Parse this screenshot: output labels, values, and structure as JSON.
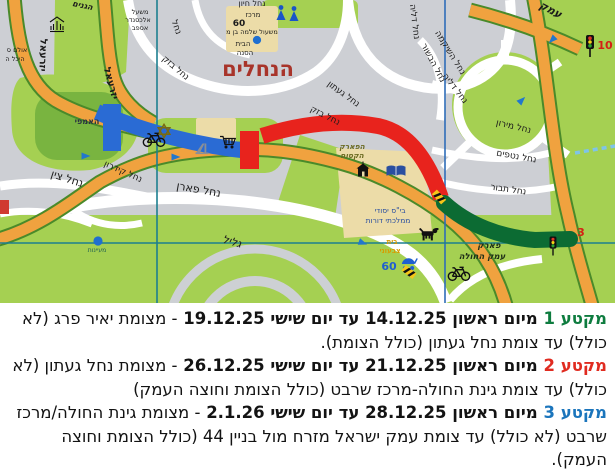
{
  "map": {
    "title": "הנחלים",
    "grid_color": "#1d7f8f",
    "route_segments": [
      {
        "name": "segment-1-closure",
        "color": "#2a6bd4"
      },
      {
        "name": "segment-2-closure",
        "color": "#e8231d"
      },
      {
        "name": "segment-3-closure",
        "color": "#0c6b33"
      }
    ],
    "labels": [
      {
        "t": "הנחלים",
        "x": 258,
        "y": 76,
        "s": 21,
        "c": "#a8342a",
        "w": 700
      },
      {
        "t": "הגנים",
        "x": 82,
        "y": 8,
        "r": 12,
        "s": 8,
        "w": 700,
        "i": true
      },
      {
        "t": "יזרעאל",
        "x": 40,
        "y": 55,
        "r": 92,
        "s": 10,
        "w": 700
      },
      {
        "t": "יזרעאל",
        "x": 108,
        "y": 84,
        "r": 75,
        "s": 10,
        "w": 700
      },
      {
        "t": "אולם ס",
        "x": 17,
        "y": 52,
        "s": 6.5
      },
      {
        "t": "היכל ה",
        "x": 15,
        "y": 61,
        "s": 6.5
      },
      {
        "t": "משעל",
        "x": 140,
        "y": 14,
        "s": 6.5
      },
      {
        "t": "אלכסנדר",
        "x": 138,
        "y": 22,
        "s": 6.5
      },
      {
        "t": "אספב",
        "x": 140,
        "y": 30,
        "s": 6.5
      },
      {
        "t": "נחל",
        "x": 174,
        "y": 28,
        "r": 70,
        "s": 9
      },
      {
        "t": "נחל בזק",
        "x": 174,
        "y": 70,
        "r": 40,
        "s": 9
      },
      {
        "t": "נחל חיון",
        "x": 252,
        "y": 6,
        "s": 8
      },
      {
        "t": "מרכז",
        "x": 253,
        "y": 17,
        "s": 7
      },
      {
        "t": "60",
        "x": 239,
        "y": 26,
        "s": 9,
        "w": 700
      },
      {
        "t": "משעול שלמה בן מ",
        "x": 252,
        "y": 34,
        "s": 6.5
      },
      {
        "t": "הבית",
        "x": 243,
        "y": 46,
        "s": 7
      },
      {
        "t": "הסנה",
        "x": 245,
        "y": 55,
        "s": 7
      },
      {
        "t": "נחל דליה",
        "x": 412,
        "y": 22,
        "r": 83,
        "s": 9
      },
      {
        "t": "נחל השיקמה",
        "x": 448,
        "y": 54,
        "r": 58,
        "s": 9
      },
      {
        "t": "נחל הבשור",
        "x": 431,
        "y": 64,
        "r": 62,
        "s": 9
      },
      {
        "t": "נחל דליה",
        "x": 453,
        "y": 90,
        "r": 52,
        "s": 9
      },
      {
        "t": "נחל געתון",
        "x": 342,
        "y": 96,
        "r": 36,
        "s": 9
      },
      {
        "t": "נחל בזק",
        "x": 324,
        "y": 118,
        "r": 27,
        "s": 9
      },
      {
        "t": "עמק",
        "x": 549,
        "y": 13,
        "r": 28,
        "s": 11,
        "w": 700,
        "i": true
      },
      {
        "t": "נחל מירון",
        "x": 513,
        "y": 129,
        "r": 13,
        "s": 9
      },
      {
        "t": "נחל נטפים",
        "x": 516,
        "y": 159,
        "r": 10,
        "s": 9
      },
      {
        "t": "נחל תבור",
        "x": 508,
        "y": 192,
        "r": 8,
        "s": 9
      },
      {
        "t": "האמפי",
        "x": 87,
        "y": 124,
        "s": 8,
        "w": 700,
        "c": "#2b3340"
      },
      {
        "t": "הפארק",
        "x": 352,
        "y": 149,
        "s": 7.5,
        "w": 700,
        "i": true,
        "c": "#6b6b22"
      },
      {
        "t": "הקסום",
        "x": 352,
        "y": 158,
        "s": 7.5,
        "w": 700,
        "i": true,
        "c": "#6b6b22"
      },
      {
        "t": "נחל קידרון",
        "x": 122,
        "y": 174,
        "r": 24,
        "s": 9
      },
      {
        "t": "נחל צין",
        "x": 66,
        "y": 182,
        "r": 18,
        "s": 11
      },
      {
        "t": "נחל פארן",
        "x": 198,
        "y": 193,
        "r": 10,
        "s": 11
      },
      {
        "t": "גליל",
        "x": 231,
        "y": 245,
        "r": 16,
        "s": 11,
        "i": true
      },
      {
        "t": "מעיינות",
        "x": 97,
        "y": 252,
        "s": 6,
        "c": "#1a5b50"
      },
      {
        "t": "בי\"ס יסודי",
        "x": 390,
        "y": 213,
        "s": 7.5,
        "c": "#2a4fa0"
      },
      {
        "t": "ממלכתי דורות",
        "x": 388,
        "y": 223,
        "s": 7.5,
        "c": "#2a4fa0"
      },
      {
        "t": "בית",
        "x": 392,
        "y": 244,
        "s": 7,
        "w": 700,
        "c": "#d89b00"
      },
      {
        "t": "צבעוני",
        "x": 390,
        "y": 253,
        "s": 7,
        "w": 700,
        "c": "#d89b00"
      },
      {
        "t": "60",
        "x": 389,
        "y": 270,
        "s": 11,
        "w": 700,
        "c": "#1f5fd0"
      },
      {
        "t": "פארק",
        "x": 489,
        "y": 248,
        "s": 8.5,
        "w": 700,
        "i": true,
        "c": "#203018"
      },
      {
        "t": "עמק החולה",
        "x": 482,
        "y": 259,
        "s": 8.5,
        "w": 700,
        "i": true,
        "c": "#203018"
      },
      {
        "t": "10",
        "x": 605,
        "y": 49,
        "s": 11,
        "w": 700,
        "c": "#d42015"
      },
      {
        "t": "3",
        "x": 581,
        "y": 236,
        "s": 11,
        "w": 700,
        "c": "#d42015"
      }
    ],
    "icons": [
      {
        "n": "people-icon",
        "x": 289,
        "y": 13,
        "w": 28,
        "h": 16
      },
      {
        "n": "synagogue-icon",
        "x": 57,
        "y": 25,
        "w": 16,
        "h": 18
      },
      {
        "n": "star-of-david-icon",
        "x": 164,
        "y": 131,
        "w": 15,
        "h": 16
      },
      {
        "n": "cart-icon",
        "x": 228,
        "y": 142,
        "w": 17,
        "h": 15
      },
      {
        "n": "playground-icon",
        "x": 202,
        "y": 148,
        "w": 15,
        "h": 13
      },
      {
        "n": "book-icon",
        "x": 396,
        "y": 171,
        "w": 19,
        "h": 13
      },
      {
        "n": "school-icon",
        "x": 363,
        "y": 170,
        "w": 15,
        "h": 17
      },
      {
        "n": "dog-icon",
        "x": 429,
        "y": 234,
        "w": 22,
        "h": 15
      },
      {
        "n": "bicycle-icon",
        "x": 154,
        "y": 139,
        "w": 25,
        "h": 17
      },
      {
        "n": "bicycle-icon",
        "x": 459,
        "y": 273,
        "w": 25,
        "h": 17
      },
      {
        "n": "stroller-icon",
        "x": 409,
        "y": 264,
        "w": 18,
        "h": 15
      },
      {
        "n": "traffic-light-icon",
        "x": 590,
        "y": 46,
        "w": 10,
        "h": 22
      },
      {
        "n": "traffic-light-icon",
        "x": 553,
        "y": 246,
        "w": 9,
        "h": 19
      },
      {
        "n": "poi-dot-icon",
        "x": 257,
        "y": 40,
        "w": 9,
        "h": 9
      },
      {
        "n": "poi-dot-icon",
        "x": 98,
        "y": 241,
        "w": 10,
        "h": 10
      },
      {
        "n": "arrow-icon",
        "x": 86,
        "y": 156,
        "w": 9,
        "h": 7,
        "r": 0
      },
      {
        "n": "arrow-icon",
        "x": 176,
        "y": 157,
        "w": 9,
        "h": 7,
        "r": 0
      },
      {
        "n": "arrow-icon",
        "x": 552,
        "y": 40,
        "w": 9,
        "h": 7,
        "r": 135
      },
      {
        "n": "arrow-icon",
        "x": 522,
        "y": 100,
        "w": 9,
        "h": 7,
        "r": -45
      },
      {
        "n": "arrow-icon",
        "x": 363,
        "y": 243,
        "w": 9,
        "h": 7,
        "r": 20
      },
      {
        "n": "hazard-icon",
        "x": 439,
        "y": 197,
        "w": 14,
        "h": 7,
        "r": 48
      },
      {
        "n": "hazard-icon",
        "x": 409,
        "y": 272,
        "w": 14,
        "h": 7,
        "r": 38
      }
    ]
  },
  "notice": {
    "sections": [
      {
        "tag": "מקטע 1",
        "tag_color": "#0e7c3f",
        "bold": "מיום ראשון 14.12.25 עד יום שישי 19.12.25",
        "rest": "- מצומת יאיר פרג (לא כולל) עד צומת נחל געתון (כולל הצומת)."
      },
      {
        "tag": "מקטע 2",
        "tag_color": "#e02b20",
        "bold": "מיום ראשון 21.12.25 עד יום שישי 26.12.25",
        "rest": "- מצומת נחל געתון (לא כולל) עד צומת גינת החולה-מרכז שרבט (כולל הצומת וחוצה העמק)"
      },
      {
        "tag": "מקטע 3",
        "tag_color": "#1b75bc",
        "bold": "מיום ראשון 28.12.25 עד יום שישי 2.1.26",
        "rest": "- מצומת גינת החולה/מרכז שרבט (לא כולל) עד צומת עמק ישראל מזרח מול בניין 44 (כולל הצומת וחוצה העמק)."
      }
    ]
  }
}
